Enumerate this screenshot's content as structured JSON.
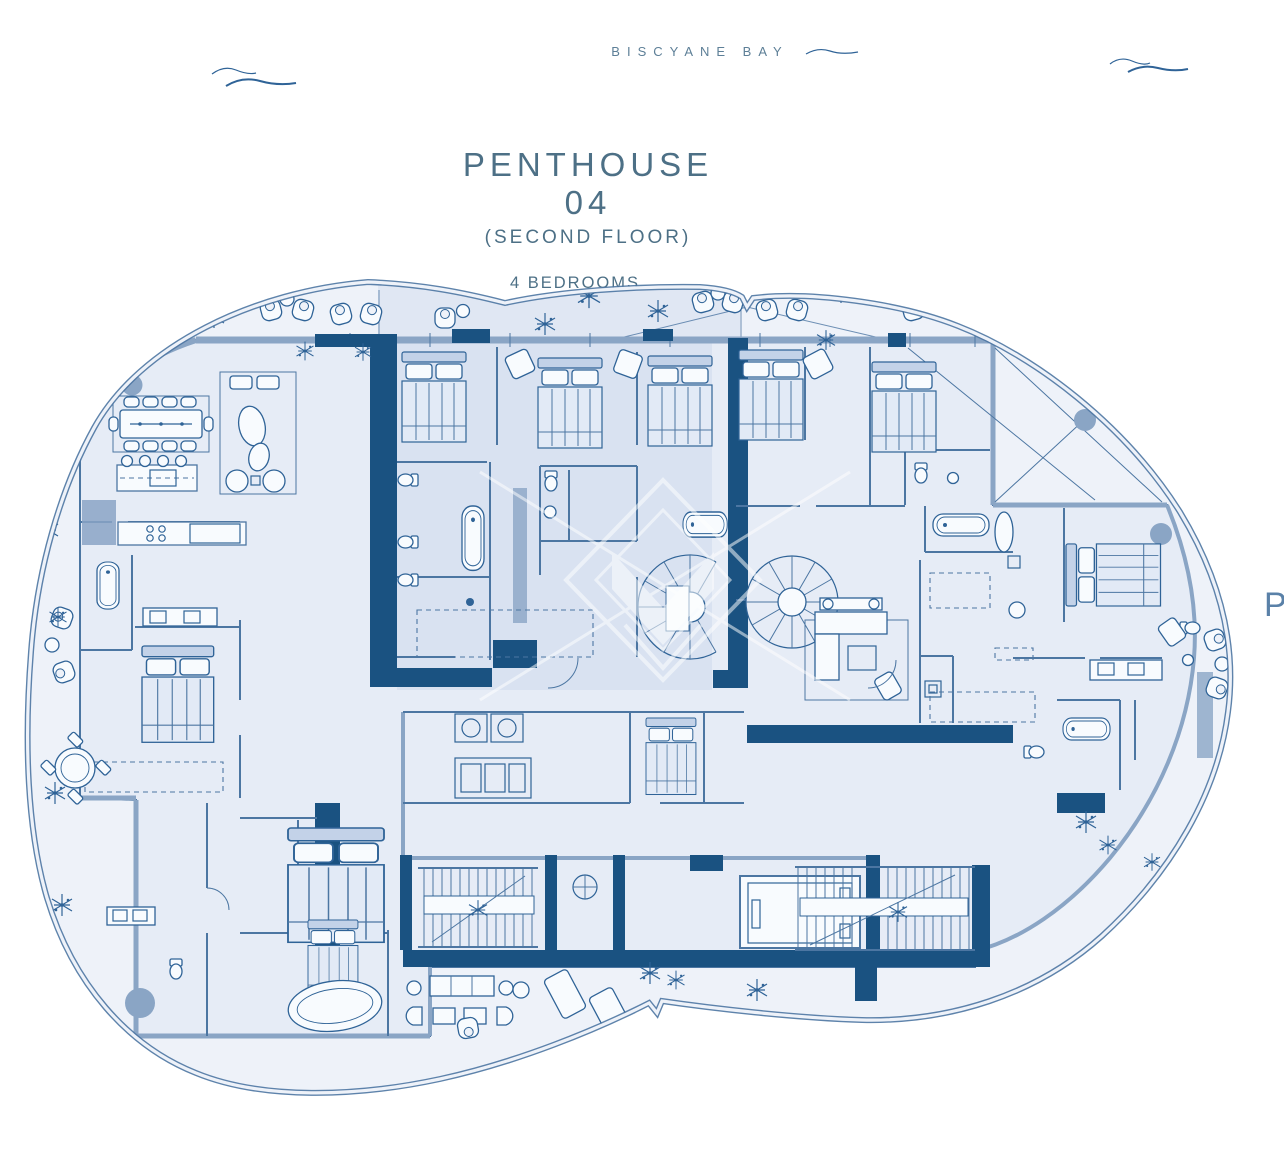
{
  "header": {
    "location": "BISCYANE BAY"
  },
  "title": {
    "name": "PENTHOUSE 04",
    "floor": "(SECOND FLOOR)",
    "bedrooms": "4 BEDROOMS",
    "bathrooms": "4 BATHROOMS"
  },
  "plan": {
    "edge_label": "P"
  },
  "colors": {
    "navy": "#1a5281",
    "line": "#4c76a2",
    "wall": "#8aa5c5",
    "ink": "#2f6397",
    "plan-bg": "#eef2f9",
    "indoor": "#e6ecf6",
    "unit": "#d6e0f0",
    "band": "#dce4f1",
    "fixture": "#f8fbfe",
    "title-text": "#4d7086",
    "location-text": "#5d7f97"
  }
}
